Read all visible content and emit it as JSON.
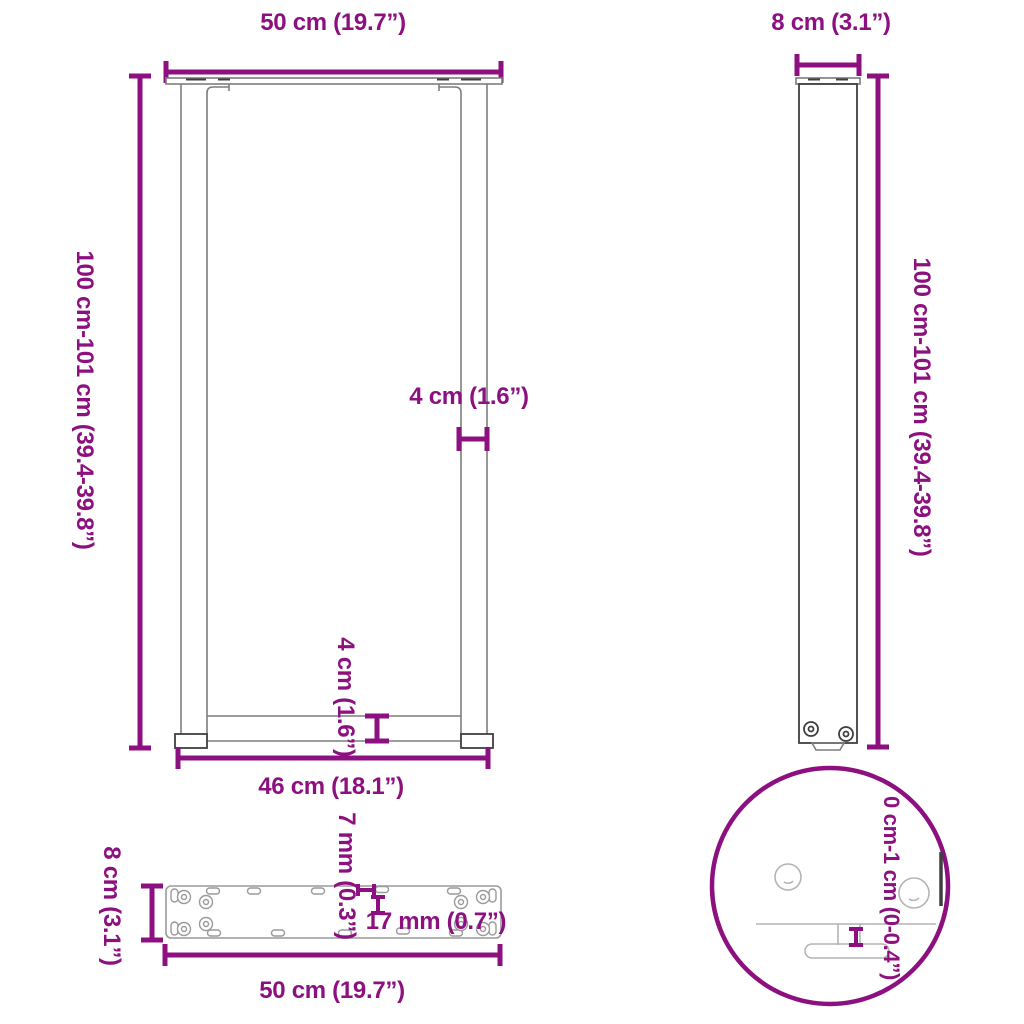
{
  "diagram": {
    "labels": {
      "front_width": "50 cm (19.7”)",
      "front_height": "100 cm-101 cm (39.4-39.8”)",
      "leg_profile_width": "4 cm (1.6”)",
      "crossbar_height": "4 cm (1.6”)",
      "inner_width": "46 cm (18.1”)",
      "side_width": "8 cm (3.1”)",
      "side_height": "100 cm-101 cm (39.4-39.8”)",
      "plate_depth": "8 cm (3.1”)",
      "plate_length": "50 cm (19.7”)",
      "slot_width": "7 mm (0.3”)",
      "slot_length": "17 mm (0.7”)",
      "foot_adjustment_range": "0 cm-1 cm (0-0.4”)"
    },
    "colors": {
      "purple": "#8c107f",
      "ink": "#3f3f3f",
      "gray": "#7d7d7d",
      "light": "#b4b4b4"
    }
  }
}
